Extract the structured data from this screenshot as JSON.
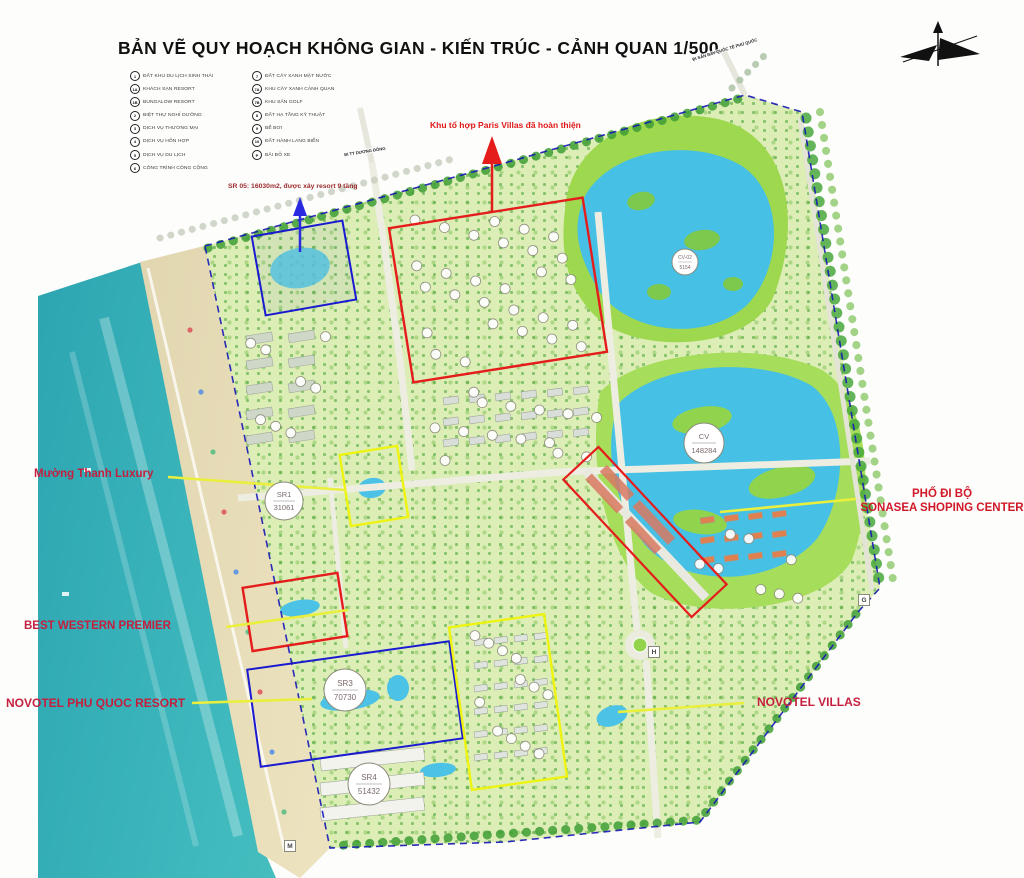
{
  "title": "BẢN VẼ QUY HOẠCH KHÔNG GIAN - KIẾN TRÚC - CẢNH QUAN 1/500",
  "legend": {
    "col1": [
      {
        "key": "1",
        "label": "ĐẤT KHU DU LỊCH SINH THÁI"
      },
      {
        "key": "1A",
        "label": "KHÁCH SẠN RESORT"
      },
      {
        "key": "1B",
        "label": "BUNGALOW RESORT"
      },
      {
        "key": "2",
        "label": "BIỆT THỰ NGHỈ DƯỠNG"
      },
      {
        "key": "3",
        "label": "DỊCH VỤ THƯƠNG MẠI"
      },
      {
        "key": "4",
        "label": "DỊCH VỤ HỖN HỢP"
      },
      {
        "key": "5",
        "label": "DỊCH VỤ DU LỊCH"
      },
      {
        "key": "6",
        "label": "CÔNG TRÌNH CÔNG CỘNG"
      }
    ],
    "col2": [
      {
        "key": "7",
        "label": "ĐẤT CÂY XANH MẶT NƯỚC"
      },
      {
        "key": "7A",
        "label": "KHU CÂY XANH CẢNH QUAN"
      },
      {
        "key": "7B",
        "label": "KHU SÂN GOLF"
      },
      {
        "key": "8",
        "label": "ĐẤT HẠ TẦNG KỸ THUẬT"
      },
      {
        "key": "9",
        "label": "BỂ BƠI"
      },
      {
        "key": "10",
        "label": "ĐẤT HÀNH LANG BIỂN"
      },
      {
        "key": "P",
        "label": "BÃI ĐỖ XE"
      }
    ]
  },
  "annotations": {
    "paris_villas": "Khu tổ hợp Paris Villas đã hoàn thiện",
    "sr05": "SR 05: 16030m2, được xây resort 9 tầng",
    "muong_thanh": "Mường Thanh Luxury",
    "pho_di_bo_line1": "PHỐ ĐI BỘ",
    "pho_di_bo_line2": "SONASEA SHOPING CENTER",
    "best_western": "BEST WESTERN PREMIER",
    "novotel_resort": "NOVOTEL PHU QUOC RESORT",
    "novotel_villas": "NOVOTEL VILLAS",
    "road_top": "ĐI TT DƯƠNG ĐÔNG",
    "road_airport": "ĐI SÂN BAY QUỐC TẾ PHÚ QUỐC"
  },
  "markers": {
    "sr1": {
      "line1": "SR1",
      "line2": "31061"
    },
    "sr3": {
      "line1": "SR3",
      "line2": "70730"
    },
    "sr4": {
      "line1": "SR4",
      "line2": "51432"
    },
    "cv": {
      "line1": "CV",
      "line2": "148284"
    },
    "cv02": {
      "line1": "CV-02",
      "line2": "5154"
    }
  },
  "corners": {
    "g": "G",
    "h": "H",
    "m": "M"
  },
  "colors": {
    "zone_red": "#e51c1c",
    "zone_blue": "#1a1ad0",
    "zone_yellow": "#eef410",
    "label_red": "#c41f3e",
    "leader_yellow": "#e9ef3c",
    "boundary_blue": "#1616b6",
    "sea": "#3fb9bd",
    "lake": "#47c0e5",
    "golf_green": "#9ed84f"
  }
}
